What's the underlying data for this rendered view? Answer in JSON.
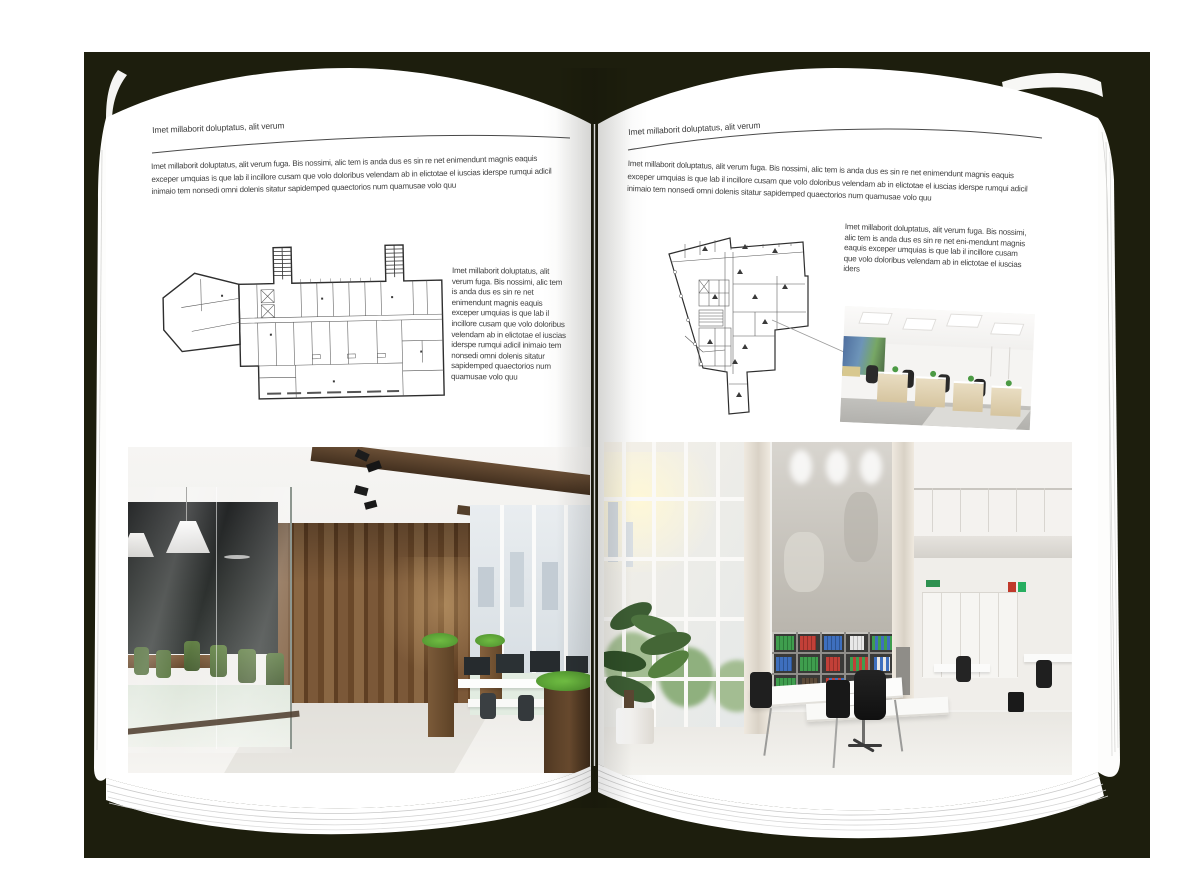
{
  "document": {
    "colors": {
      "backdrop": "#1d1e0d",
      "canvas": "#ffffff",
      "page": "#ffffff",
      "text": "#414141",
      "rule": "#4a4a4a"
    },
    "left_page": {
      "header": "Imet millaborit doluptatus, alit verum",
      "intro": "Imet millaborit doluptatus, alit verum fuga. Bis nossimi, alic tem is anda dus es sin re net enimendunt magnis eaquis exceper umquias is que lab il incillore cusam que volo doloribus velendam ab in elictotae el iuscias iderspe rumqui adicil inimaio tem nonsedi omni dolenis sitatur sapidemped quaectorios num quamusae volo quu",
      "side_text": "Imet millaborit doluptatus, alit verum fuga. Bis nossimi, alic tem is anda dus es sin re net enimendunt magnis eaquis exceper umquias is que lab il incillore cusam que volo doloribus velendam ab in elictotae el iuscias iderspe rumqui adicil inimaio tem nonsedi omni dolenis sitatur sapidemped quaectorios num quamusae volo quu",
      "floorplan_alt": "rectangular-building-floor-plan-with-two-stair-towers",
      "photo_alt": "office-interior-glass-meeting-room-wood-wall"
    },
    "right_page": {
      "header": "Imet millaborit doluptatus, alit verum",
      "intro": "Imet millaborit doluptatus, alit verum fuga. Bis nossimi, alic tem is anda dus es sin re net enimendunt magnis eaquis exceper umquias is que lab il incillore cusam que volo doloribus velendam ab in elictotae el iuscias iderspe rumqui adicil inimaio tem nonsedi omni dolenis sitatur sapidemped quaectorios num quamusae volo quu",
      "side_text": "Imet millaborit doluptatus, alit verum fuga. Bis nossimi, alic tem is anda dus es sin re net eni-mendunt magnis eaquis exceper umquias is que lab il incillore cusam que volo doloribus velendam ab in elictotae el iuscias iders",
      "floorplan_alt": "irregular-building-floor-plan",
      "photo_small_alt": "open-plan-office-ceiling-light-panels",
      "photo_large_alt": "bright-atrium-office-bookshelf-binders"
    }
  }
}
